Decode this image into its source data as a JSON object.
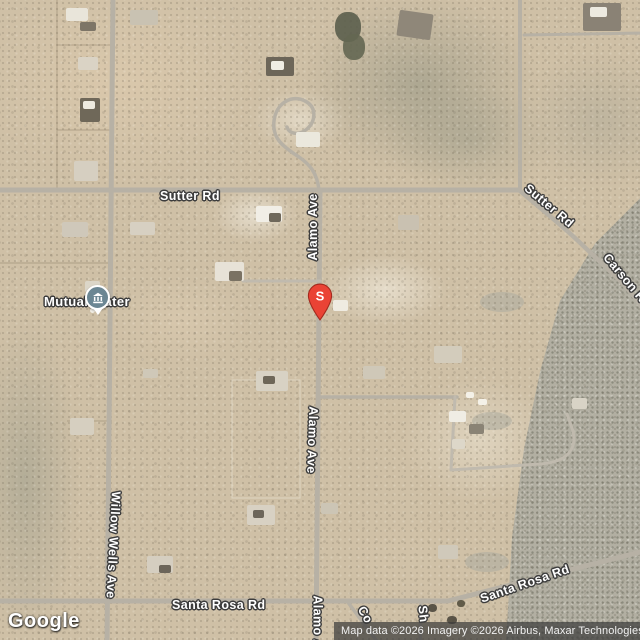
{
  "map": {
    "watermark": "Google",
    "attribution": "Map data ©2026 Imagery ©2026 Airbus, Maxar Technologies",
    "marker": {
      "label": "S",
      "color": "#EA4335",
      "type": "red-pin"
    },
    "poi": {
      "label": "Mutual Water",
      "icon": "town-hall-icon",
      "color": "#6B8693"
    },
    "road_labels": {
      "sutter_left": "Sutter Rd",
      "sutter_right": "Sutter Rd",
      "carson": "Carson Rd",
      "alamo_top": "Alamo Ave",
      "alamo_mid": "Alamo Ave",
      "alamo_bottom": "Alamo Ave",
      "willow": "Willow Wells Ave",
      "santa_rosa_left": "Santa Rosa Rd",
      "santa_rosa_right": "Santa Rosa Rd",
      "co_partial": "Co",
      "sh_partial": "Sh"
    },
    "colors": {
      "sand": "#CFC0A6",
      "scrub": "#B2AFA2",
      "road": "#B7B1A5"
    }
  }
}
